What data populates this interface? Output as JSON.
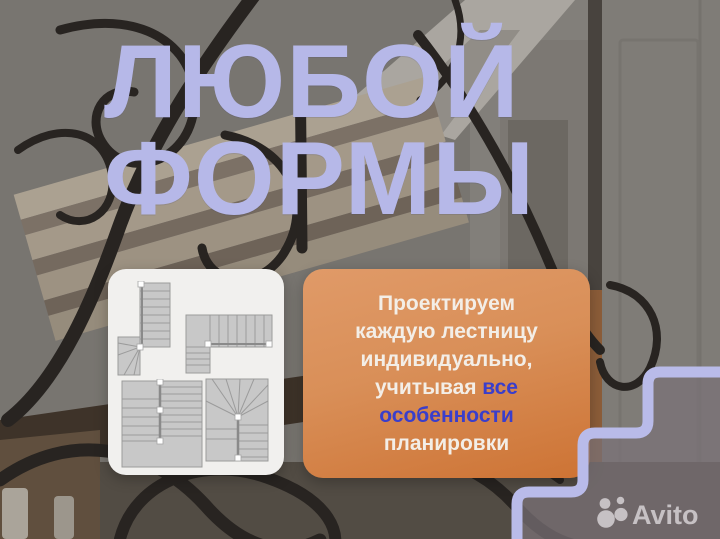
{
  "meta": {
    "kind": "marketplace-ad-creative",
    "subject": "custom staircases"
  },
  "headline": {
    "line1": "ЛЮБОЙ",
    "line2": "ФОРМЫ"
  },
  "plans_card": {
    "plans": [
      {
        "name": "l-shaped-stair-with-winders"
      },
      {
        "name": "l-shaped-stair-with-landing"
      },
      {
        "name": "u-shaped-stair-with-landing"
      },
      {
        "name": "u-shaped-stair-with-winders"
      }
    ]
  },
  "promo_card": {
    "line1": "Проектируем",
    "line2": "каждую лестницу",
    "line3": "индивидуально,",
    "line4a": "учитывая",
    "line4b": "все",
    "line5": "особенности",
    "line6": "планировки"
  },
  "watermark": {
    "brand": "Avito"
  },
  "colors": {
    "headline": "#b6b8e8",
    "promo_card_top": "#e09a68",
    "promo_card_bottom": "#cd7334",
    "promo_accent": "#3a3ecb",
    "step_outline": "#b9bbe9"
  }
}
